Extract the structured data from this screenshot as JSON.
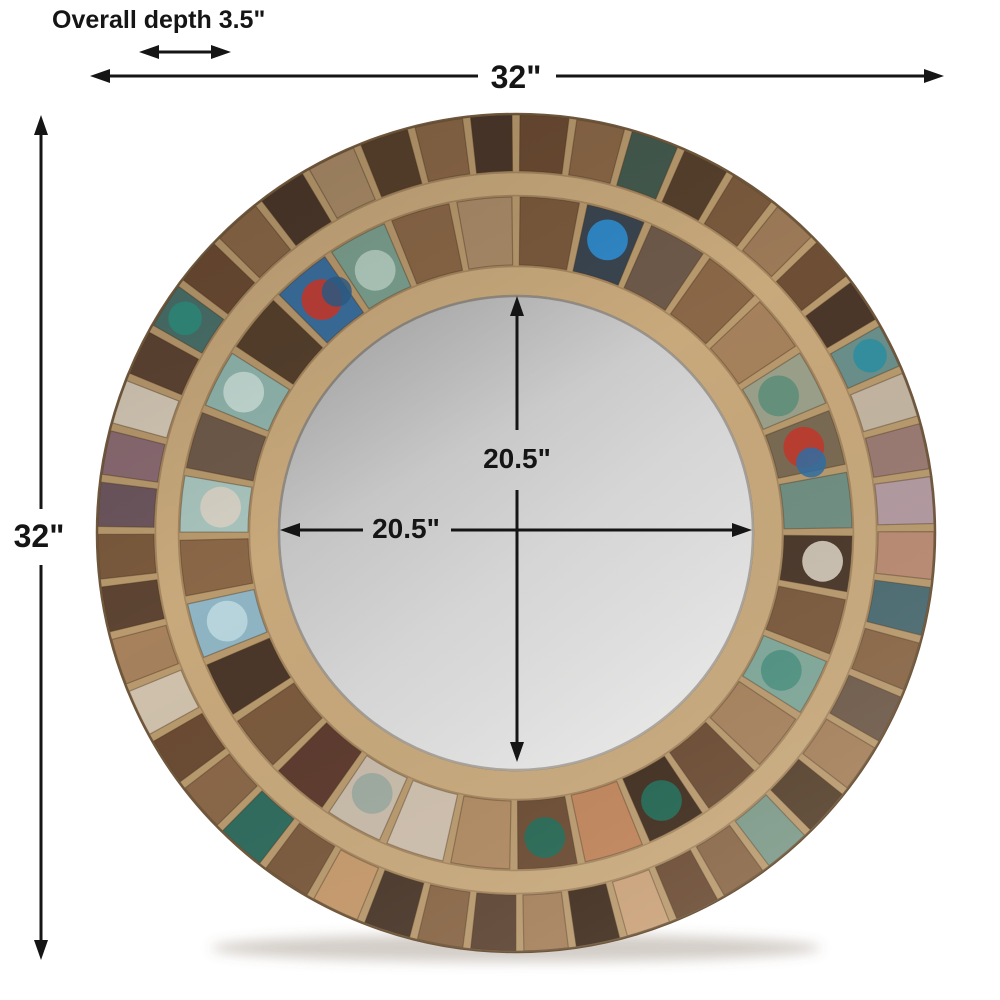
{
  "page": {
    "title": "Round reclaimed wood mirror dimension diagram",
    "background": "#ffffff"
  },
  "annotation_color": "#151515",
  "dimensions": {
    "overall_depth_label": "Overall depth 3.5\"",
    "overall_width_label": "32\"",
    "overall_height_label": "32\"",
    "mirror_width_label": "20.5\"",
    "mirror_height_label": "20.5\""
  },
  "mirror": {
    "glass_gradient": [
      "#aeaeae",
      "#d9d9d9",
      "#efefef"
    ],
    "wood_base": "#b99a6e",
    "wood_trim_light": "#c8a97c",
    "wood_trim_edge": "#8a6b49",
    "outer_edge": "#6f573c",
    "shadow_color": "rgba(110,90,70,0.30)",
    "outer_segments": [
      "#6b4b33",
      "#8a6747",
      "#445a4e",
      "#55402c",
      "#7b5a3d",
      "#9c7a58",
      "#6e4f35",
      "#4a372a",
      {
        "c": "#6a8f8a",
        "p": "#2e8fa0"
      },
      "#c3b5a2",
      "#9a7a72",
      "#b29aa0",
      "#b98a72",
      "#4a6b72",
      "#8a6747",
      "#6e5a4a",
      "#a6815c",
      "#55402c",
      "#7d9a8a",
      "#8a6747",
      "#6b4b33",
      "#caa27a",
      "#3f2c1e",
      "#a6815c",
      "#5d4433",
      "#8a6747",
      "#4a372a",
      "#c69a6b",
      "#7b5a3d",
      "#2e6b5e",
      "#8a6747",
      "#6b4b33",
      "#d0c2ad",
      "#a6815c",
      "#5d4433",
      "#7b5a3d",
      "#6d565e",
      "#8a6a72",
      "#d4c8b6",
      "#5d4433",
      {
        "c": "#49706a",
        "p": "#2e8f80"
      },
      "#6b4b33",
      "#8a6747",
      "#4a372a",
      "#a98b68",
      "#57402c",
      "#8a6747",
      "#4a372a"
    ],
    "inner_segments": [
      "#7b5a3d",
      {
        "c": "#3a4550",
        "p": "#2f8fd4"
      },
      "#6e5a4a",
      "#8a6747",
      "#a6815c",
      {
        "c": "#9aa08a",
        "p": "#5f8f7a"
      },
      {
        "c": "#7a6a52",
        "p": "#c0392b",
        "q": "#2e6da4"
      },
      "#6f8f82",
      {
        "c": "#4a372a",
        "p": "#d8cfc0"
      },
      "#7b5a3d",
      {
        "c": "#7fa89a",
        "p": "#4a8f80"
      },
      "#a6815c",
      "#6b4b33",
      {
        "c": "#3f2c1e",
        "p": "#1e6b58"
      },
      "#c0845a",
      {
        "c": "#6b4b33",
        "p": "#1e6b58"
      },
      "#b08a62",
      "#cfc0ae",
      {
        "c": "#c9bcab",
        "p": "#9aa8a0"
      },
      "#5d3a2e",
      "#7b5a3d",
      "#4a372a",
      {
        "c": "#8fb5c4",
        "p": "#bcd8e0"
      },
      "#8a6747",
      {
        "c": "#a8c4bd",
        "p": "#d8d2c4"
      },
      "#6e5a4a",
      {
        "c": "#8fb5ad",
        "p": "#c8ddd6"
      },
      "#55402c",
      {
        "c": "#3a6f9e",
        "p": "#cc3a2c",
        "q": "#2e5f8a"
      },
      {
        "c": "#7ba08f",
        "p": "#b8d0c4"
      },
      "#8a6747",
      "#a98b68"
    ]
  }
}
